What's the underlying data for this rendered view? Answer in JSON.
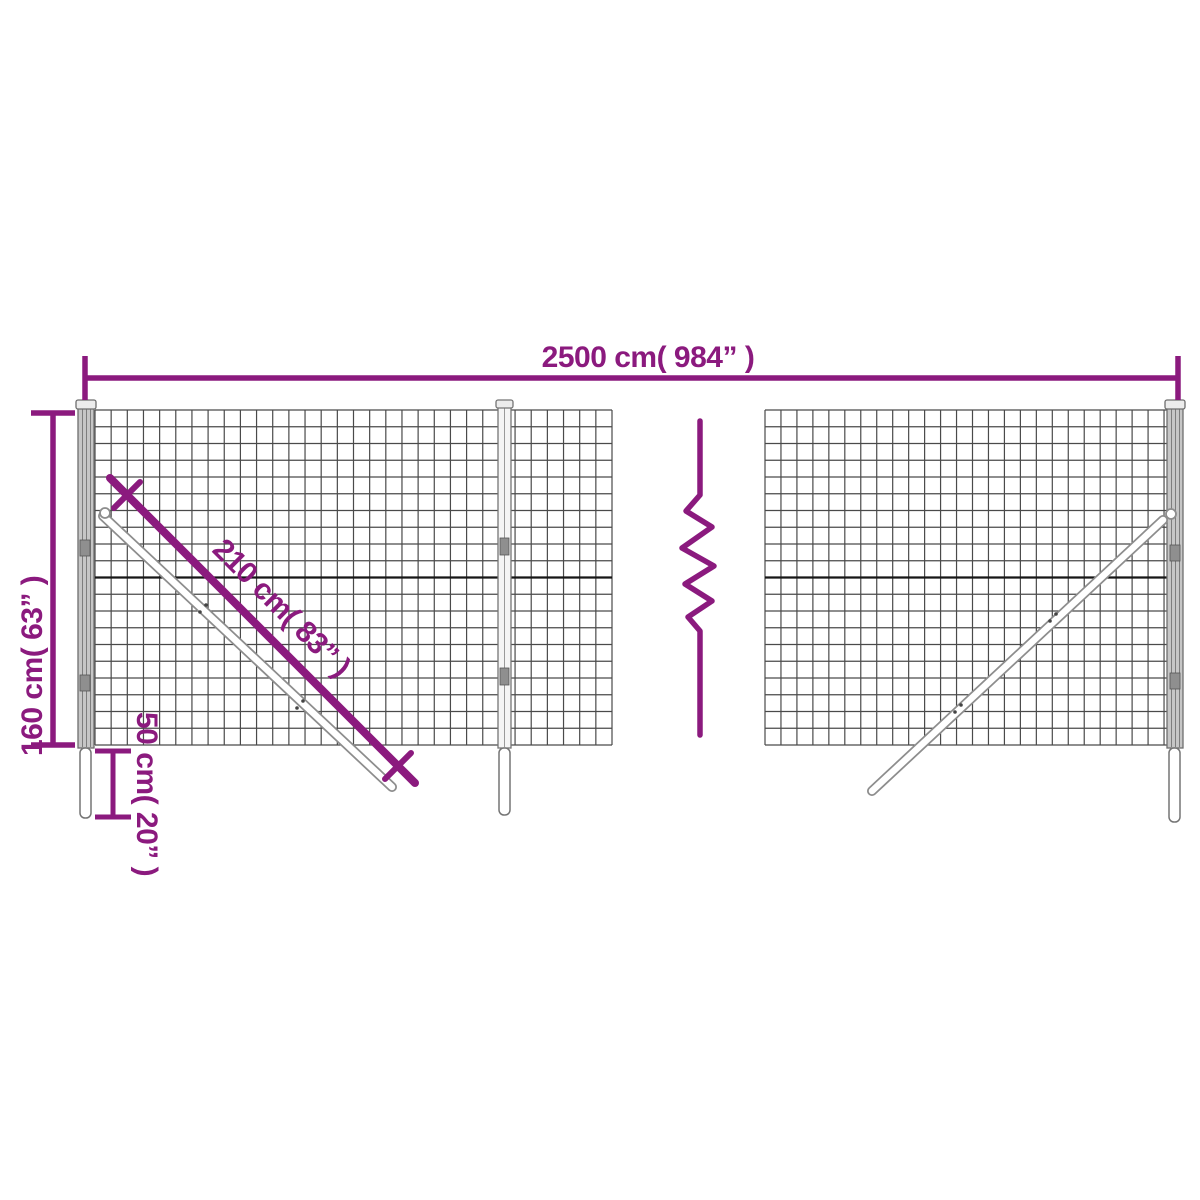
{
  "diagram": {
    "type": "product-dimension-drawing",
    "subject": "wire-mesh-fence-with-posts-and-ground-stakes",
    "annotations": {
      "total_width_label": "2500 cm( 984” )",
      "height_label": "160 cm( 63” )",
      "brace_length_label": "210 cm( 83” )",
      "stake_depth_label": "50 cm( 20” )"
    },
    "colors": {
      "annotation": "#8b1a7e",
      "mesh_wire": "#4a4a4a",
      "mesh_mid_wire": "#161616",
      "post_fill": "#c6c6c6",
      "post_outline": "#6e6e6e",
      "brace_outline": "#8d8d8d",
      "background": "#ffffff"
    }
  }
}
